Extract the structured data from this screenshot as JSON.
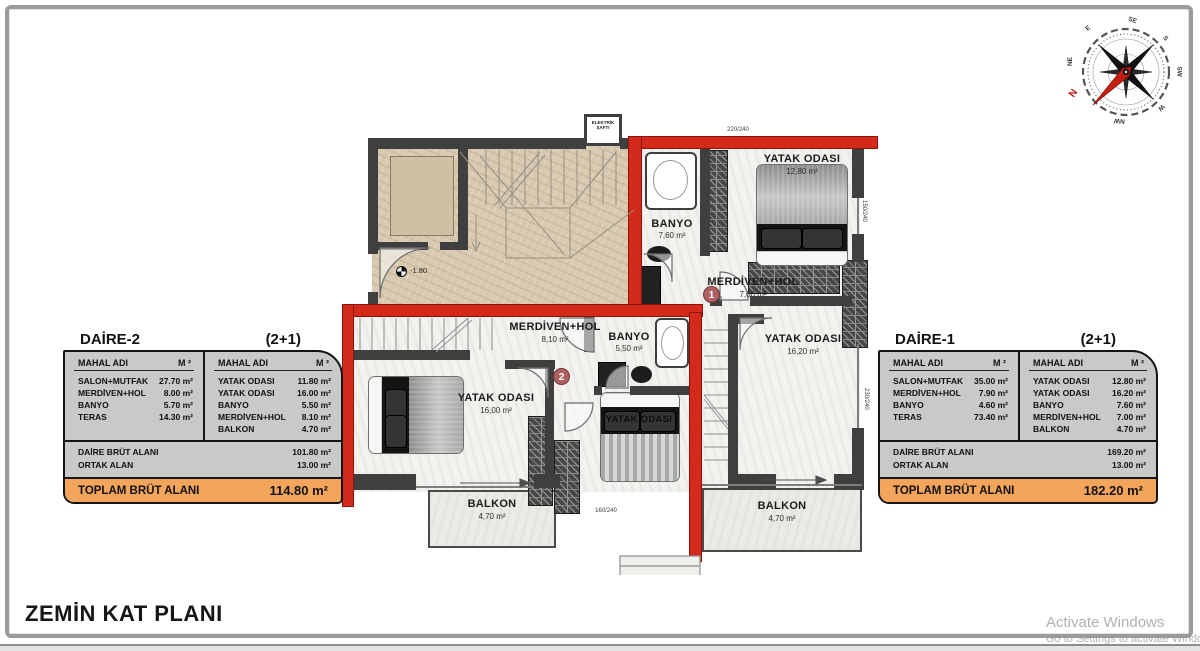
{
  "page": {
    "title": "ZEMİN KAT PLANI"
  },
  "watermark": {
    "line1": "Activate Windows",
    "line2": "Go to Settings to activate Windows."
  },
  "compass": {
    "n": "N",
    "ne": "NE",
    "e": "E",
    "se": "SE",
    "s": "S",
    "sw": "SW",
    "w": "W",
    "nw": "NW"
  },
  "plan": {
    "shaft_label": "ELEKTRİK ŞAFTI",
    "level": "-1.80",
    "dims": {
      "top": "220/240",
      "right_upper": "150/240",
      "right_lower": "230/240",
      "bottom": "160/240"
    },
    "d1": {
      "banyo": {
        "name": "BANYO",
        "area": "7,60 m²"
      },
      "yatak1": {
        "name": "YATAK ODASI",
        "area": "12,80 m²"
      },
      "hol": {
        "name": "MERDİVEN+HOL",
        "area": "7,00 m²",
        "badge": "1"
      },
      "yatak2": {
        "name": "YATAK ODASI",
        "area": "16,20 m²"
      },
      "balkon": {
        "name": "BALKON",
        "area": "4,70 m²"
      }
    },
    "d2": {
      "hol": {
        "name": "MERDİVEN+HOL",
        "area": "8,10 m²",
        "badge": "2"
      },
      "banyo": {
        "name": "BANYO",
        "area": "5,50 m²"
      },
      "yatak1": {
        "name": "YATAK ODASI",
        "area": "16,00 m²"
      },
      "yatak2": {
        "name": "YATAK ODASI"
      },
      "balkon": {
        "name": "BALKON",
        "area": "4,70 m²"
      }
    }
  },
  "tables": [
    {
      "title": "DAİRE-2",
      "type": "(2+1)",
      "header": {
        "name": "MAHAL ADI",
        "unit": "M ²"
      },
      "left_rows": [
        [
          "SALON+MUTFAK",
          "27.70 m²"
        ],
        [
          "MERDİVEN+HOL",
          "8.00 m²"
        ],
        [
          "BANYO",
          "5.70 m²"
        ],
        [
          "TERAS",
          "14.30 m²"
        ]
      ],
      "right_rows": [
        [
          "YATAK ODASI",
          "11.80 m²"
        ],
        [
          "YATAK ODASI",
          "16.00 m²"
        ],
        [
          "BANYO",
          "5.50 m²"
        ],
        [
          "MERDİVEN+HOL",
          "8.10 m²"
        ],
        [
          "BALKON",
          "4.70 m²"
        ]
      ],
      "summary": [
        [
          "DAİRE BRÜT ALANI",
          "101.80 m²"
        ],
        [
          "ORTAK ALAN",
          "13.00 m²"
        ]
      ],
      "total": {
        "label": "TOPLAM BRÜT ALANI",
        "value": "114.80 m²"
      }
    },
    {
      "title": "DAİRE-1",
      "type": "(2+1)",
      "header": {
        "name": "MAHAL ADI",
        "unit": "M ²"
      },
      "left_rows": [
        [
          "SALON+MUTFAK",
          "35.00 m²"
        ],
        [
          "MERDİVEN+HOL",
          "7.90 m²"
        ],
        [
          "BANYO",
          "4.60 m²"
        ],
        [
          "TERAS",
          "73.40 m²"
        ]
      ],
      "right_rows": [
        [
          "YATAK ODASI",
          "12.80 m²"
        ],
        [
          "YATAK ODASI",
          "16.20 m²"
        ],
        [
          "BANYO",
          "7.60 m²"
        ],
        [
          "MERDİVEN+HOL",
          "7.00 m²"
        ],
        [
          "BALKON",
          "4.70 m²"
        ]
      ],
      "summary": [
        [
          "DAİRE BRÜT ALANI",
          "169.20 m²"
        ],
        [
          "ORTAK ALAN",
          "13.00 m²"
        ]
      ],
      "total": {
        "label": "TOPLAM BRÜT ALANI",
        "value": "182.20 m²"
      }
    }
  ]
}
